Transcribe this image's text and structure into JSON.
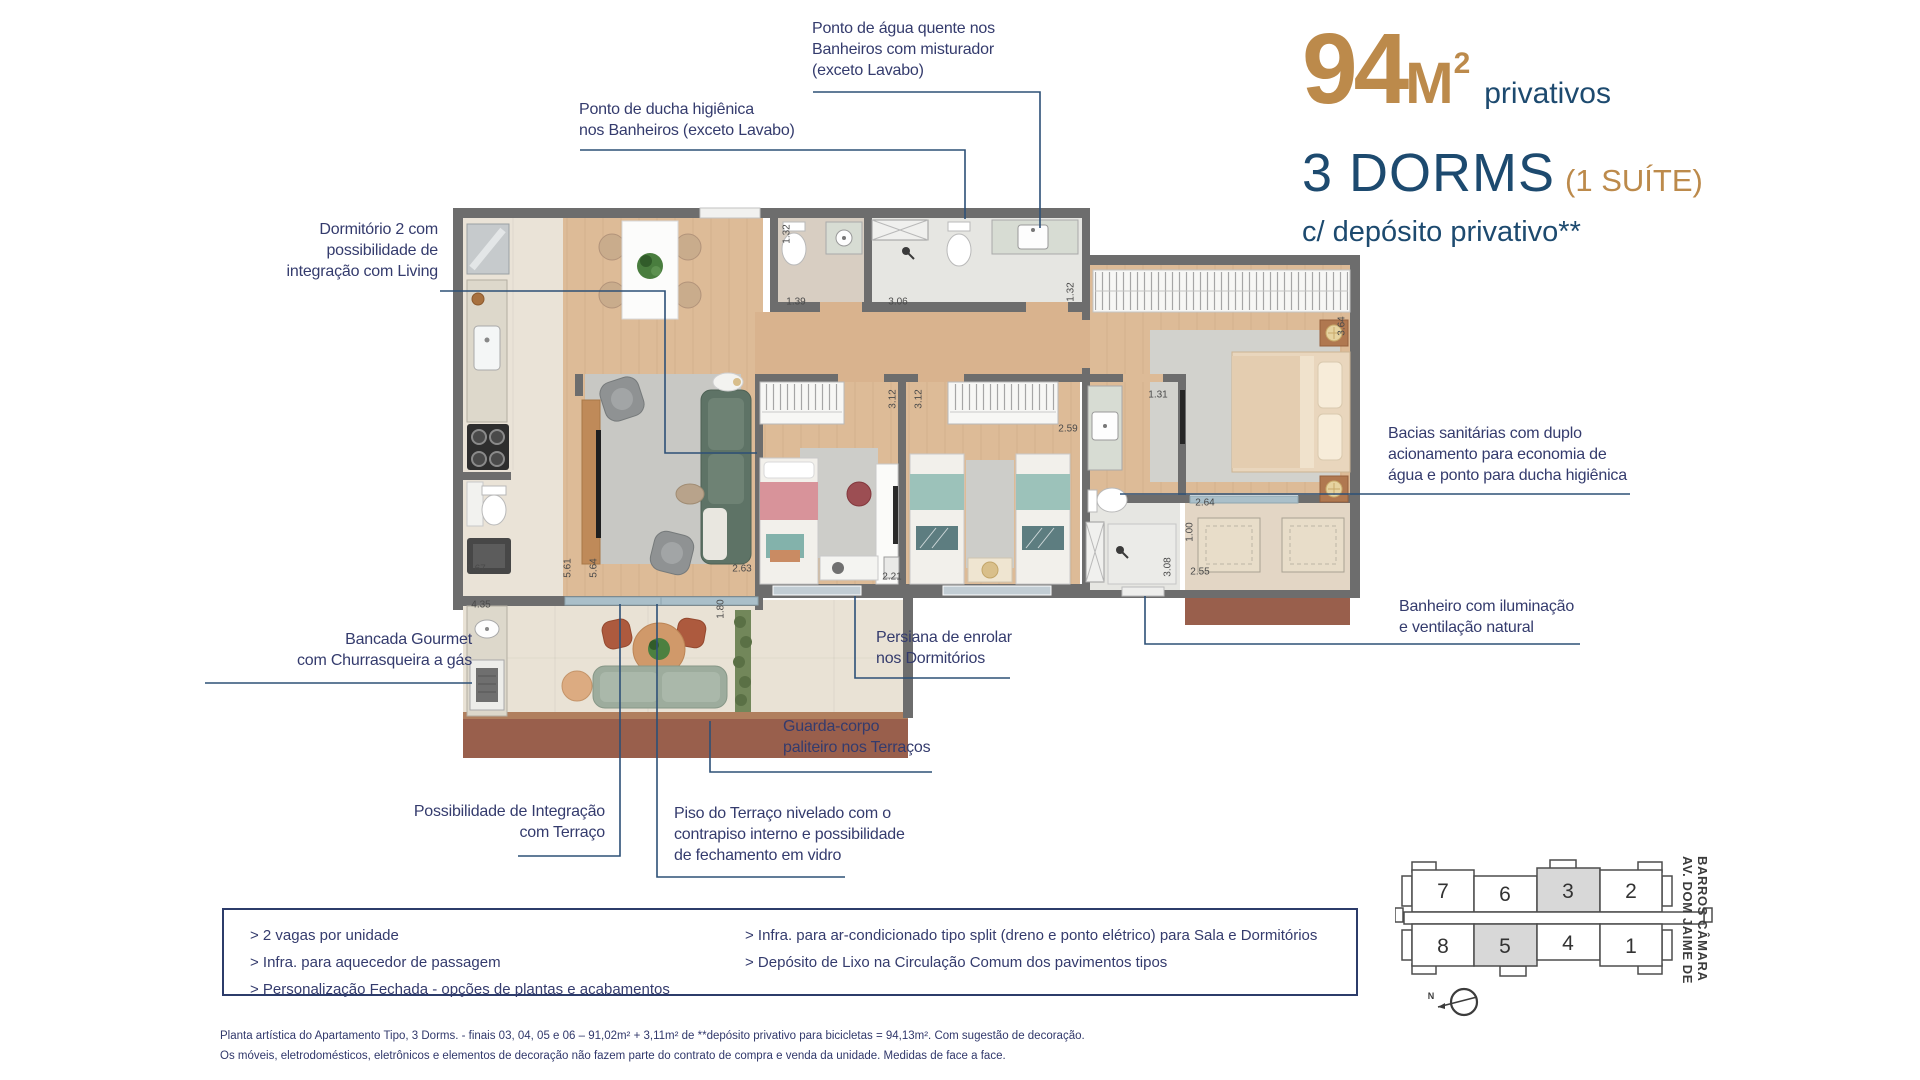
{
  "title": {
    "area_number": "94",
    "area_unit": "M",
    "area_sup": "2",
    "area_note": "privativos",
    "dorms": "3 DORMS",
    "suite_note": "(1 SUÍTE)",
    "deposit_note": "c/ depósito privativo**"
  },
  "callouts": {
    "agua_quente": "Ponto de água quente nos\nBanheiros com misturador\n(exceto Lavabo)",
    "ducha": "Ponto de ducha higiênica\nnos Banheiros (exceto Lavabo)",
    "dormitorio2": "Dormitório 2 com\npossibilidade de\nintegração com Living",
    "bacias": "Bacias sanitárias com duplo\nacionamento para economia de\nágua e ponto para ducha higiênica",
    "banheiro": "Banheiro com iluminação\ne ventilação natural",
    "bancada": "Bancada Gourmet\ncom Churrasqueira a gás",
    "persiana": "Persiana de enrolar\nnos Dormitórios",
    "guarda_corpo": "Guarda-corpo\npaliteiro nos Terraços",
    "integracao": "Possibilidade de Integração\ncom Terraço",
    "piso": "Piso do Terraço nivelado com o\ncontrapiso interno e possibilidade\nde fechamento em vidro"
  },
  "features": {
    "left": [
      "> 2 vagas por unidade",
      "> Infra. para aquecedor de passagem",
      "> Personalização Fechada - opções de plantas e acabamentos"
    ],
    "right": [
      "> Infra. para ar-condicionado tipo split (dreno e ponto elétrico) para Sala e Dormitórios",
      "> Depósito de Lixo na Circulação Comum dos pavimentos tipos"
    ]
  },
  "disclaimer": {
    "text": "Planta artística do Apartamento Tipo, 3 Dorms. - finais 03, 04, 05 e 06 – 91,02m² + 3,11m² de **depósito privativo para bicicletas = 94,13m². Com sugestão de decoração.\nOs móveis, eletrodomésticos, eletrônicos e elementos de decoração não fazem parte do contrato de compra e venda da unidade. Medidas de face a face."
  },
  "keyplan": {
    "street": "AV. DOM JAIME DE\nBARROS CÂMARA",
    "north": "N",
    "units_top": [
      "7",
      "6",
      "3",
      "2"
    ],
    "units_bottom": [
      "8",
      "5",
      "4",
      "1"
    ],
    "highlighted_units": [
      "3",
      "5"
    ]
  },
  "plan": {
    "dimensions": [
      {
        "label": "1.32",
        "x": 787,
        "y": 234,
        "v": true
      },
      {
        "label": "1.39",
        "x": 796,
        "y": 302
      },
      {
        "label": "3.06",
        "x": 898,
        "y": 302
      },
      {
        "label": "1.32",
        "x": 1071,
        "y": 292,
        "v": true
      },
      {
        "label": "3.64",
        "x": 1342,
        "y": 326,
        "v": true
      },
      {
        "label": "3.12",
        "x": 893,
        "y": 399,
        "v": true
      },
      {
        "label": "3.12",
        "x": 919,
        "y": 399,
        "v": true
      },
      {
        "label": "2.59",
        "x": 1068,
        "y": 429
      },
      {
        "label": "1.31",
        "x": 1158,
        "y": 395
      },
      {
        "label": "2.64",
        "x": 1205,
        "y": 503
      },
      {
        "label": "1.00",
        "x": 1190,
        "y": 532,
        "v": true
      },
      {
        "label": "3.08",
        "x": 1168,
        "y": 567,
        "v": true
      },
      {
        "label": "2.55",
        "x": 1200,
        "y": 572
      },
      {
        "label": "2.21",
        "x": 892,
        "y": 577
      },
      {
        "label": "2.63",
        "x": 742,
        "y": 569
      },
      {
        "label": "5.64",
        "x": 594,
        "y": 568,
        "v": true
      },
      {
        "label": "5.61",
        "x": 568,
        "y": 568,
        "v": true
      },
      {
        "label": "1.67",
        "x": 476,
        "y": 569
      },
      {
        "label": "4.35",
        "x": 481,
        "y": 605
      },
      {
        "label": "1.80",
        "x": 721,
        "y": 609,
        "v": true
      }
    ]
  },
  "colors": {
    "gold": "#bc8a4b",
    "navy_heading": "#1d4a6f",
    "callout_text": "#343b6d",
    "callout_line": "#2d5077",
    "wall": "#6d6d6d",
    "wood_floor": "#ddbb97",
    "deck": "#995f4c",
    "keyplan_highlight": "#d8d8d8"
  }
}
